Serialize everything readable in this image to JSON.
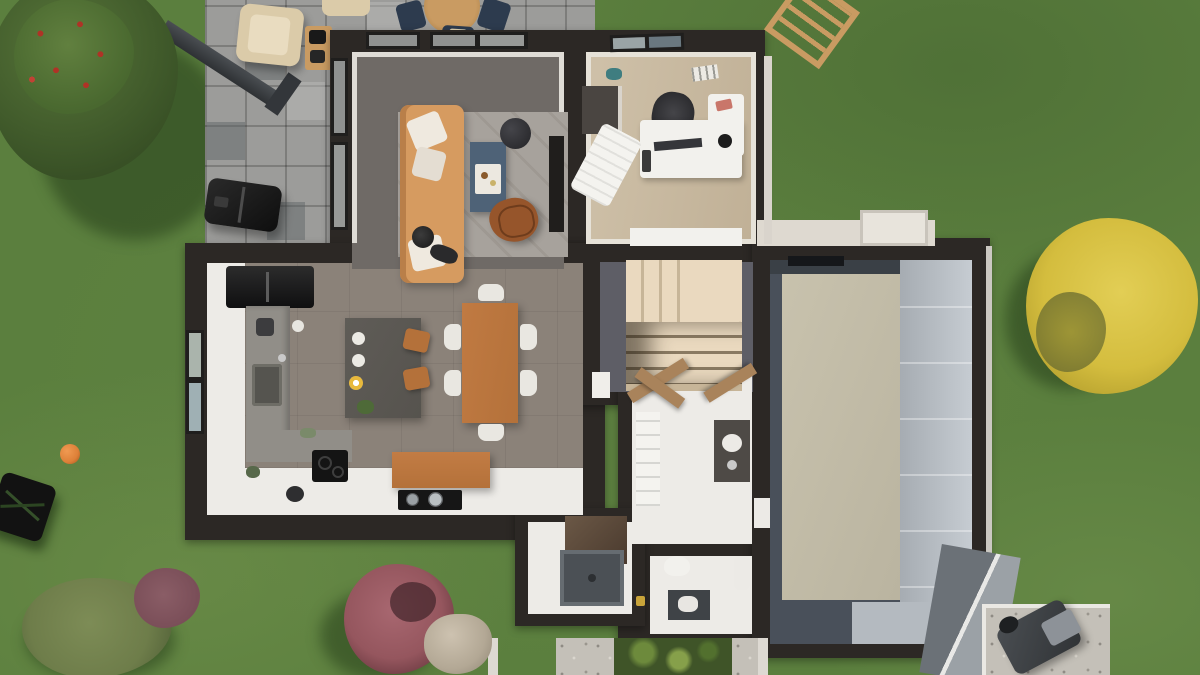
{
  "scene": {
    "title": "3D top-down floor plan render of a single-family house with garden",
    "view": "top-down cutaway",
    "style": "photorealistic architectural visualization",
    "no_visible_text": true
  },
  "palette": {
    "grass": "#5b7f3e",
    "grassdark": "#4e7134",
    "grasslight": "#6c8f4e",
    "paving": "#9c9c9a",
    "pavegap": "#737574",
    "wall": "#2c2825",
    "wall2": "#413b37",
    "livfloor": "#6f6a66",
    "woodfloor": "#cfc1a9",
    "taupe": "#8b8279",
    "whitefloor": "#edebe7",
    "hallfloor": "#5e5e66",
    "stair1": "#ead9bf",
    "stair2": "#c7b598",
    "gfloor": "#49505a",
    "gslab": "#c8c2ad",
    "gpanel": "#b9bfc5",
    "concrete": "#918e88",
    "island": "#56534e",
    "black": "#1c1b1a",
    "wood": "#b4713a",
    "woodlt": "#c99b62",
    "sofa": "#d69b60",
    "rug": "#a7a29c",
    "btable": "#4e6277",
    "leather": "#96552b",
    "whitef": "#f2f1ed",
    "navy": "#2d3b4e",
    "beige": "#dbcba9",
    "gravel": "#c4c0b8",
    "walkway": "#ded9d0",
    "tgreen": "#41582b",
    "tred": "#ae3326",
    "tyellow": "#d4bd3e",
    "bpurple": "#95565e",
    "olive": "#6e7d4a",
    "rock": "#b3a895",
    "ball": "#dd8038",
    "shed": "#6b7177",
    "shedlt": "#9ba1a6",
    "doorwood": "#a9835b"
  },
  "rooms": [
    {
      "id": "living-room",
      "floor": "gray tile",
      "furniture": [
        "orange sofa with white pillows",
        "gray rug",
        "blue coffee table with tray",
        "black round pouf",
        "leather butterfly chair",
        "black tv cabinet",
        "floor plant"
      ]
    },
    {
      "id": "home-office",
      "floor": "light wood",
      "furniture": [
        "white l-desk with monitor",
        "black office chair",
        "dark cabinet",
        "white lounge chair",
        "white sideboard",
        "ceiling vent"
      ]
    },
    {
      "id": "kitchen-dining",
      "floor": "taupe tile with white screed border",
      "furniture": [
        "black fridge",
        "concrete l-counter with sink",
        "black cooktop",
        "dark kitchen island with two wood stools and plates",
        "wood dining table with six white chairs",
        "wood sideboard",
        "black hob with pots"
      ]
    },
    {
      "id": "hallway-stairs",
      "floor": "dark gray tile",
      "furniture": [
        "u-shaped wooden winder staircase",
        "open wooden door"
      ]
    },
    {
      "id": "storage-laundry",
      "floor": "white",
      "furniture": [
        "white shelving",
        "dark vanity with sink",
        "two open wooden doors",
        "dark brown closet"
      ]
    },
    {
      "id": "shower-room",
      "floor": "white",
      "furniture": [
        "dark gray shower tray"
      ]
    },
    {
      "id": "wc-room",
      "floor": "white",
      "furniture": [
        "toilet",
        "dark washbasin",
        "water heater",
        "amber bottle"
      ]
    },
    {
      "id": "garage",
      "floor": "dark slate",
      "furniture": [
        "beige ceiling slab",
        "light paneled sectional wall",
        "side door niche",
        "dark lintel"
      ]
    },
    {
      "id": "entrance-walkway",
      "floor": "light concrete",
      "furniture": [
        "white porch block"
      ]
    }
  ],
  "outdoor": [
    "paved tile terrace top-left with accent tiles",
    "beige lounge armchair",
    "second beige armchair at top edge",
    "wood side table with black grill tools",
    "round wood dining table with navy chairs",
    "black bbq grill",
    "dark carport beam diagonal",
    "apple tree with red fruit",
    "yellow tree",
    "red-purple bush with rock",
    "olive shrub with purple accent bush",
    "orange ball",
    "black garden table",
    "teal sprinkler",
    "wooden ladder frame top-right",
    "gravel patio bottom-right with dark lounge chair",
    "gray gabled shed roof",
    "planting bed with lawn, white curbs, gravel strips and green plants"
  ]
}
